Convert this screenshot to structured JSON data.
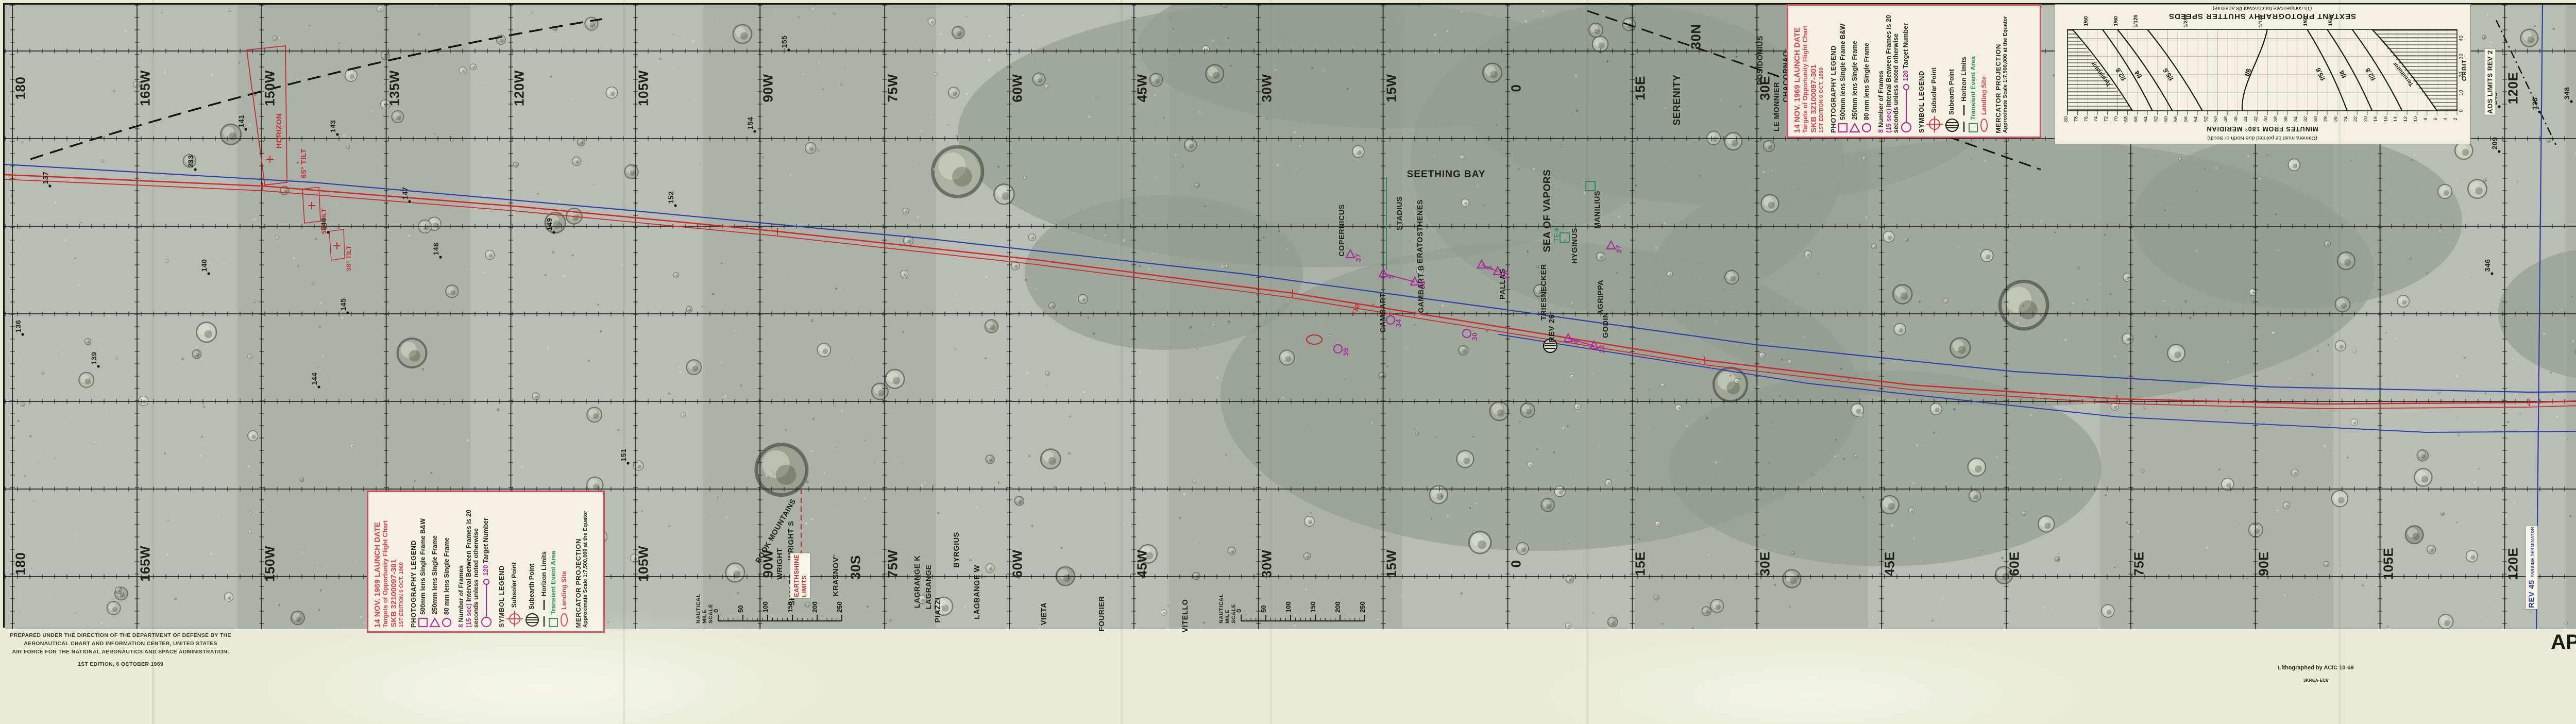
{
  "page": {
    "title_line": "APOLLO TARGETS OF OPPORTUNITY FLIGHT CHART (ATO)",
    "mission_line": "APOLLO MISSION 12",
    "launch_line": "14 NOVEMBER 1969 LAUNCH DATE"
  },
  "attribution": {
    "lines": [
      "PREPARED UNDER THE DIRECTION OF THE DEPARTMENT OF DEFENSE BY THE",
      "AERONAUTICAL CHART AND INFORMATION CENTER, UNITED STATES",
      "AIR FORCE FOR THE NATIONAL AERONAUTICS AND SPACE ADMINISTRATION.",
      "1ST EDITION, 6 OCTOBER 1969"
    ]
  },
  "print_note": {
    "line1": "Lithographed by ACIC 10-69",
    "line2": "3KREA-EC6"
  },
  "legend": {
    "lines": [
      {
        "text": "14 NOV. 1969 LAUNCH DATE",
        "color": "red",
        "size": "lg"
      },
      {
        "text": "Targets of Opportunity Flight Chart",
        "color": "red",
        "size": "rg"
      },
      {
        "text": "SKB 32100097-301",
        "color": "red",
        "size": "lg"
      },
      {
        "text": "1ST EDITION 6 OCT. 1969",
        "color": "red",
        "size": "sm"
      },
      {
        "text": "PHOTOGRAPHY LEGEND",
        "color": "blk",
        "size": "md",
        "gap": true
      },
      {
        "text": "500mm lens Single Frame B&W",
        "color": "blk",
        "size": "rg",
        "symbol": "square"
      },
      {
        "text": "250mm lens Single Frame",
        "color": "blk",
        "size": "rg",
        "symbol": "triangle"
      },
      {
        "text": "80 mm lens Single Frame",
        "color": "blk",
        "size": "rg",
        "symbol": "circle"
      },
      {
        "prefix": "8 ",
        "text": "Number of Frames",
        "color": "blk",
        "size": "rg",
        "gap": true
      },
      {
        "prefix": "(15 sec) ",
        "text": "Interval Between Frames is 20",
        "color": "blk",
        "size": "rg"
      },
      {
        "text": "seconds unless noted otherwise",
        "color": "blk",
        "size": "rg"
      },
      {
        "prefix": "120 ",
        "text": "Target Number",
        "color": "blk",
        "size": "rg",
        "symbol": "target-line"
      },
      {
        "text": "SYMBOL LEGEND",
        "color": "blk",
        "size": "md",
        "gap": true
      },
      {
        "text": "Subsolar Point",
        "color": "blk",
        "size": "rg",
        "symbol": "subsolar"
      },
      {
        "text": "Subearth Point",
        "color": "blk",
        "size": "rg",
        "symbol": "subearth"
      },
      {
        "text": "Horizon Limits",
        "color": "blk",
        "size": "rg",
        "symbol": "dashes"
      },
      {
        "text": "Transient Event Area",
        "color": "grn",
        "size": "rg",
        "symbol": "green-square"
      },
      {
        "text": "Landing Site",
        "color": "red",
        "size": "rg",
        "symbol": "red-ellipse"
      },
      {
        "text": "MERCATOR PROJECTION",
        "color": "blk",
        "size": "md",
        "gap": true
      },
      {
        "text": "Approximate Scale 1:7,500,000 at the Equator",
        "color": "blk",
        "size": "sm"
      }
    ]
  },
  "margin_id": {
    "lines": [
      {
        "text": "SKB 32100097-301",
        "size": 17
      },
      {
        "text": "S/N",
        "size": 15
      },
      {
        "text": "14 NOV. 1969 LAUNCH DATE",
        "size": 17
      },
      {
        "text": "1ST EDITION, 6 OCTOBER 1969",
        "size": 10.5
      }
    ]
  },
  "chart_data": {
    "type": "line",
    "title": "SEXTANT PHOTOGRAPHY SHUTTER SPEEDS",
    "subtitle": "(To compensate for constant f/8 aperture)",
    "note": "(Camera must be pointed due North or South)",
    "xlabel": "MINUTES FROM 180° MERIDIAN",
    "x_range": [
      2,
      80
    ],
    "x_tick_step": 2,
    "ylabel": "ORBIT",
    "y_ticks": [
      0,
      10,
      20,
      30,
      40
    ],
    "orientation": "printed rotated 180 degrees on chart",
    "grid": true,
    "curves": [
      {
        "name": "Terminator",
        "side": "left-printed",
        "minutes_at_orbit0": 67,
        "minutes_at_orbit45": 79
      },
      {
        "name": "f/2.8",
        "side": "left-printed",
        "shutter": "1/60",
        "minutes_at_orbit0": 63,
        "minutes_at_orbit45": 73
      },
      {
        "name": "f/4",
        "side": "left-printed",
        "shutter": "1/60",
        "minutes_at_orbit0": 59,
        "minutes_at_orbit45": 70
      },
      {
        "name": "f/5.6",
        "side": "left-printed",
        "shutter": "1/125",
        "minutes_at_orbit0": 53,
        "minutes_at_orbit45": 64
      },
      {
        "name": "f/8",
        "side": "center",
        "shutter": "1/250",
        "minutes_at_orbit0": 45,
        "minutes_at_orbit45": 40
      },
      {
        "name": "f/5.6",
        "side": "right-printed",
        "shutter": "1/125",
        "minutes_at_orbit0": 24,
        "minutes_at_orbit45": 32
      },
      {
        "name": "f/4",
        "side": "right-printed",
        "shutter": "1/60",
        "minutes_at_orbit0": 19,
        "minutes_at_orbit45": 28
      },
      {
        "name": "f/2.8",
        "side": "right-printed",
        "shutter": "1/60",
        "minutes_at_orbit0": 13,
        "minutes_at_orbit45": 23
      },
      {
        "name": "Terminator",
        "side": "right-printed",
        "minutes_at_orbit0": 6,
        "minutes_at_orbit45": 19
      }
    ],
    "shutter_label_minutes": [
      76,
      70,
      66,
      56,
      41,
      32,
      27
    ],
    "shutter_labels": [
      "1/60",
      "1/60",
      "1/125",
      "1/250",
      "1/125",
      "1/60",
      "1/60"
    ]
  },
  "map": {
    "meridian_labels": [
      "180",
      "165W",
      "150W",
      "135W",
      "120W",
      "105W",
      "90W",
      "75W",
      "60W",
      "45W",
      "30W",
      "15W",
      "0",
      "15E",
      "30E",
      "45E",
      "60E",
      "75E",
      "90E",
      "105E",
      "120E",
      "135E",
      "150E",
      "165E",
      "180"
    ],
    "latitude_labels": [
      {
        "text": "30N",
        "x": 3283,
        "y": 62
      },
      {
        "text": "30S",
        "x": 1652,
        "y": 1092
      },
      {
        "text": "30S",
        "x": 5452,
        "y": 1092
      }
    ],
    "sea_labels": [
      {
        "text": "SERENITY",
        "x": 3247,
        "y": 185
      },
      {
        "text": "SEETHING BAY",
        "x": 2798,
        "y": 330,
        "horizontal": true
      },
      {
        "text": "SEA OF VAPORS",
        "x": 2995,
        "y": 400
      }
    ],
    "crater_labels": [
      {
        "text": "ROOK MOUNTAINS",
        "x": 1497,
        "y": 1022,
        "rot": -60
      },
      {
        "text": "WRIGHT S",
        "x": 1527,
        "y": 1040
      },
      {
        "text": "WRIGHT",
        "x": 1505,
        "y": 1085
      },
      {
        "text": "SHALER",
        "x": 1529,
        "y": 1135
      },
      {
        "text": "KRASNOV",
        "x": 1614,
        "y": 1110
      },
      {
        "text": "LAGRANGE K",
        "x": 1772,
        "y": 1120
      },
      {
        "text": "LAGRANGE",
        "x": 1794,
        "y": 1130
      },
      {
        "text": "PIAZZI",
        "x": 1812,
        "y": 1175
      },
      {
        "text": "BYRGIUS",
        "x": 1848,
        "y": 1058
      },
      {
        "text": "LAGRANGE W",
        "x": 1888,
        "y": 1140
      },
      {
        "text": "VIETA",
        "x": 2018,
        "y": 1182
      },
      {
        "text": "FOURIER",
        "x": 2130,
        "y": 1182
      },
      {
        "text": "VITELLO",
        "x": 2292,
        "y": 1186
      },
      {
        "text": "POSIDONIUS",
        "x": 3408,
        "y": 108
      },
      {
        "text": "CHACORNAC",
        "x": 3458,
        "y": 140
      },
      {
        "text": "LE MONNIER",
        "x": 3440,
        "y": 198
      },
      {
        "text": "COPERNICUS",
        "x": 2596,
        "y": 438
      },
      {
        "text": "STADIUS",
        "x": 2708,
        "y": 405
      },
      {
        "text": "ERATOSTHENES",
        "x": 2748,
        "y": 440
      },
      {
        "text": "GAMBART",
        "x": 2676,
        "y": 598
      },
      {
        "text": "GAMBART B",
        "x": 2750,
        "y": 552
      },
      {
        "text": "PALLAS",
        "x": 2908,
        "y": 542
      },
      {
        "text": "TRIESNECKER",
        "x": 2988,
        "y": 558
      },
      {
        "text": "HYGINUS",
        "x": 3048,
        "y": 468
      },
      {
        "text": "MANILIUS",
        "x": 3092,
        "y": 398
      },
      {
        "text": "AGRIPPA",
        "x": 3098,
        "y": 568
      },
      {
        "text": "GODIN",
        "x": 3108,
        "y": 622
      }
    ],
    "numbered_points": [
      {
        "n": "136",
        "x": 35,
        "y": 640
      },
      {
        "n": "137",
        "x": 88,
        "y": 352
      },
      {
        "n": "139",
        "x": 182,
        "y": 702
      },
      {
        "n": "140",
        "x": 396,
        "y": 522
      },
      {
        "n": "141",
        "x": 468,
        "y": 242
      },
      {
        "n": "143",
        "x": 646,
        "y": 252
      },
      {
        "n": "144",
        "x": 610,
        "y": 742
      },
      {
        "n": "145",
        "x": 666,
        "y": 598
      },
      {
        "n": "147",
        "x": 786,
        "y": 382
      },
      {
        "n": "148",
        "x": 846,
        "y": 490
      },
      {
        "n": "149",
        "x": 1066,
        "y": 442
      },
      {
        "n": "151",
        "x": 1210,
        "y": 890
      },
      {
        "n": "152",
        "x": 1302,
        "y": 390
      },
      {
        "n": "154",
        "x": 1456,
        "y": 246
      },
      {
        "n": "155",
        "x": 1522,
        "y": 88
      },
      {
        "n": "233",
        "x": 370,
        "y": 320
      },
      {
        "n": "240",
        "x": 628,
        "y": 442
      },
      {
        "n": "119",
        "x": 4832,
        "y": 165
      },
      {
        "n": "123",
        "x": 4920,
        "y": 208
      },
      {
        "n": "209",
        "x": 4842,
        "y": 285
      },
      {
        "n": "345",
        "x": 4842,
        "y": 198
      },
      {
        "n": "346",
        "x": 4828,
        "y": 522
      },
      {
        "n": "348",
        "x": 4982,
        "y": 188
      },
      {
        "n": "351",
        "x": 5028,
        "y": 142
      },
      {
        "n": "353",
        "x": 5102,
        "y": 332
      },
      {
        "n": "355",
        "x": 5238,
        "y": 278
      },
      {
        "n": "357",
        "x": 5312,
        "y": 432
      },
      {
        "n": "359",
        "x": 5452,
        "y": 1122
      },
      {
        "n": "370",
        "x": 5722,
        "y": 1102
      },
      {
        "n": "371",
        "x": 5732,
        "y": 1152
      },
      {
        "n": "375",
        "x": 5812,
        "y": 1148
      }
    ],
    "targets": [
      {
        "n": "37",
        "shape": "triangle",
        "x": 2612,
        "y": 485
      },
      {
        "n": "5",
        "shape": "triangle",
        "x": 2676,
        "y": 522
      },
      {
        "n": "33",
        "shape": "triangle",
        "x": 2737,
        "y": 538
      },
      {
        "n": "34",
        "shape": "circle",
        "x": 2690,
        "y": 612
      },
      {
        "n": "3",
        "shape": "triangle",
        "x": 2867,
        "y": 505
      },
      {
        "n": "28",
        "shape": "triangle",
        "x": 2898,
        "y": 518
      },
      {
        "n": "30",
        "shape": "circle",
        "x": 2838,
        "y": 638
      },
      {
        "n": "4",
        "shape": "triangle",
        "x": 3035,
        "y": 648
      },
      {
        "n": "22",
        "shape": "triangle",
        "x": 3085,
        "y": 662
      },
      {
        "n": "27",
        "shape": "triangle",
        "x": 3118,
        "y": 468
      },
      {
        "n": "39",
        "shape": "circle",
        "x": 2588,
        "y": 668
      }
    ],
    "target_links": [
      [
        1,
        2
      ],
      [
        4,
        5
      ],
      [
        7,
        8
      ]
    ],
    "te_areas": [
      {
        "text": "TE-6",
        "x": 3028,
        "y": 452
      },
      {
        "text": "",
        "x": 3078,
        "y": 352
      }
    ],
    "tilt_annotations": [
      {
        "text": "HORIZON",
        "x": 512,
        "y": 205,
        "size": 14
      },
      {
        "text": "65° TILT",
        "x": 560,
        "y": 268,
        "size": 14
      },
      {
        "text": "50° TILT",
        "x": 600,
        "y": 380,
        "size": 12
      },
      {
        "text": "30° TILT",
        "x": 648,
        "y": 452,
        "size": 12
      }
    ],
    "earthshine": {
      "line1": "EARTHSHINE",
      "line2": "LIMITS",
      "x": 1544,
      "y": 1108
    },
    "rev_ribbons": [
      {
        "rev": "REV 45",
        "sub": "FARSIDE TERMINATOR",
        "color": "#2f3fa8",
        "x": 4905,
        "y": 1092
      },
      {
        "rev": "REV 30",
        "sub": "FARSIDE TERMINATOR",
        "color": "#c32b2f",
        "x": 5152,
        "y": 1090
      },
      {
        "rev": "REV 15",
        "sub": "FARSIDE TERMINATOR",
        "color": "#a62a9a",
        "x": 5398,
        "y": 1106
      },
      {
        "rev": "REV 1",
        "sub": "FARSIDE TERMINATOR",
        "color": "#2e8b63",
        "x": 5632,
        "y": 1108
      }
    ],
    "aos_ribbon": {
      "text": "AOS LIMITS REV 2",
      "x": 4824,
      "y": 150
    },
    "rev26": {
      "text": "REV 26",
      "x": 3003,
      "y": 628
    },
    "plus10": {
      "text": "+10",
      "x": 2622,
      "y": 592
    },
    "scalebar": {
      "label": "NAUTICAL MILE SCALE",
      "ticks": [
        "0",
        "50",
        "100",
        "150",
        "200",
        "250"
      ],
      "positions": [
        {
          "x": 1385,
          "y": 1150
        },
        {
          "x": 2400,
          "y": 1150
        },
        {
          "x": 5300,
          "y": 1150
        }
      ]
    },
    "landing_site": {
      "x": 2542,
      "y": 650
    }
  }
}
